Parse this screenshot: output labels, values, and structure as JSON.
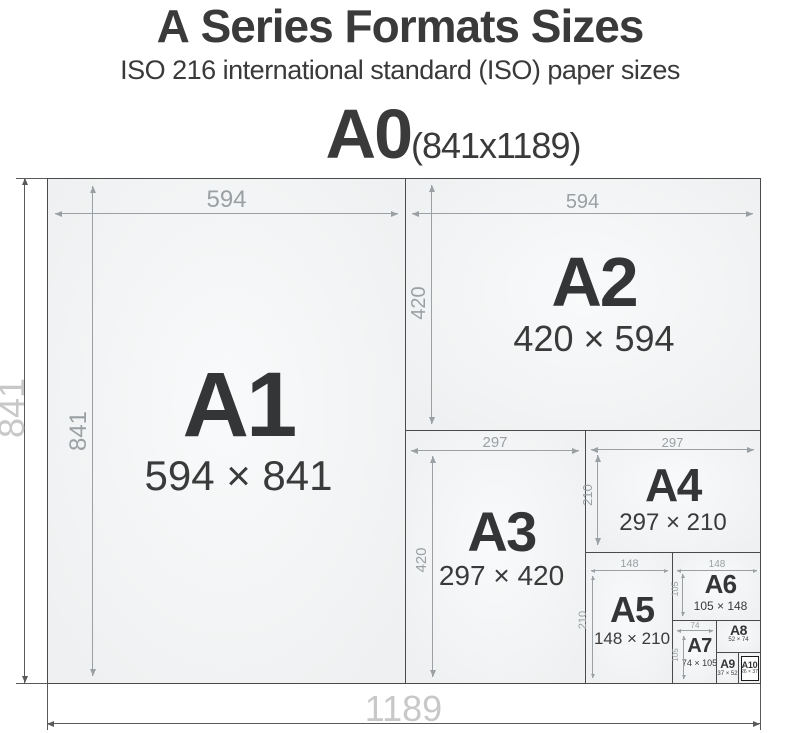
{
  "header": {
    "title_black": "A",
    "title_rest": "Series Formats Sizes",
    "subtitle": "ISO 216 international standard (ISO) paper sizes",
    "a0_label": "A0",
    "a0_size": "(841x1189)"
  },
  "diagram": {
    "outer": {
      "width_label": "1189",
      "height_label": "841"
    },
    "papers": [
      {
        "id": "a1",
        "label": "A1",
        "size": "594 × 841",
        "top_dim": "594",
        "side_dim": "841"
      },
      {
        "id": "a2",
        "label": "A2",
        "size": "420 × 594",
        "top_dim": "594",
        "side_dim": "420"
      },
      {
        "id": "a3",
        "label": "A3",
        "size": "297 × 420",
        "top_dim": "297",
        "side_dim": "420"
      },
      {
        "id": "a4",
        "label": "A4",
        "size": "297 × 210",
        "top_dim": "297",
        "side_dim": "210"
      },
      {
        "id": "a5",
        "label": "A5",
        "size": "148 × 210",
        "top_dim": "148",
        "side_dim": "210"
      },
      {
        "id": "a6",
        "label": "A6",
        "size": "105 × 148",
        "top_dim": "148",
        "side_dim": "105"
      },
      {
        "id": "a7",
        "label": "A7",
        "size": "74 × 105",
        "top_dim": "74",
        "side_dim": "105"
      },
      {
        "id": "a8",
        "label": "A8",
        "size": "52 × 74"
      },
      {
        "id": "a9",
        "label": "A9",
        "size": "37 × 52"
      },
      {
        "id": "a10",
        "label": "A10",
        "size": "26 × 37"
      }
    ]
  },
  "colors": {
    "ink": "#3a3a3a",
    "dim": "#9aa0a3",
    "faint": "#c8c8c8",
    "border": "#4a4a4a",
    "paper": "#eef0f1"
  }
}
